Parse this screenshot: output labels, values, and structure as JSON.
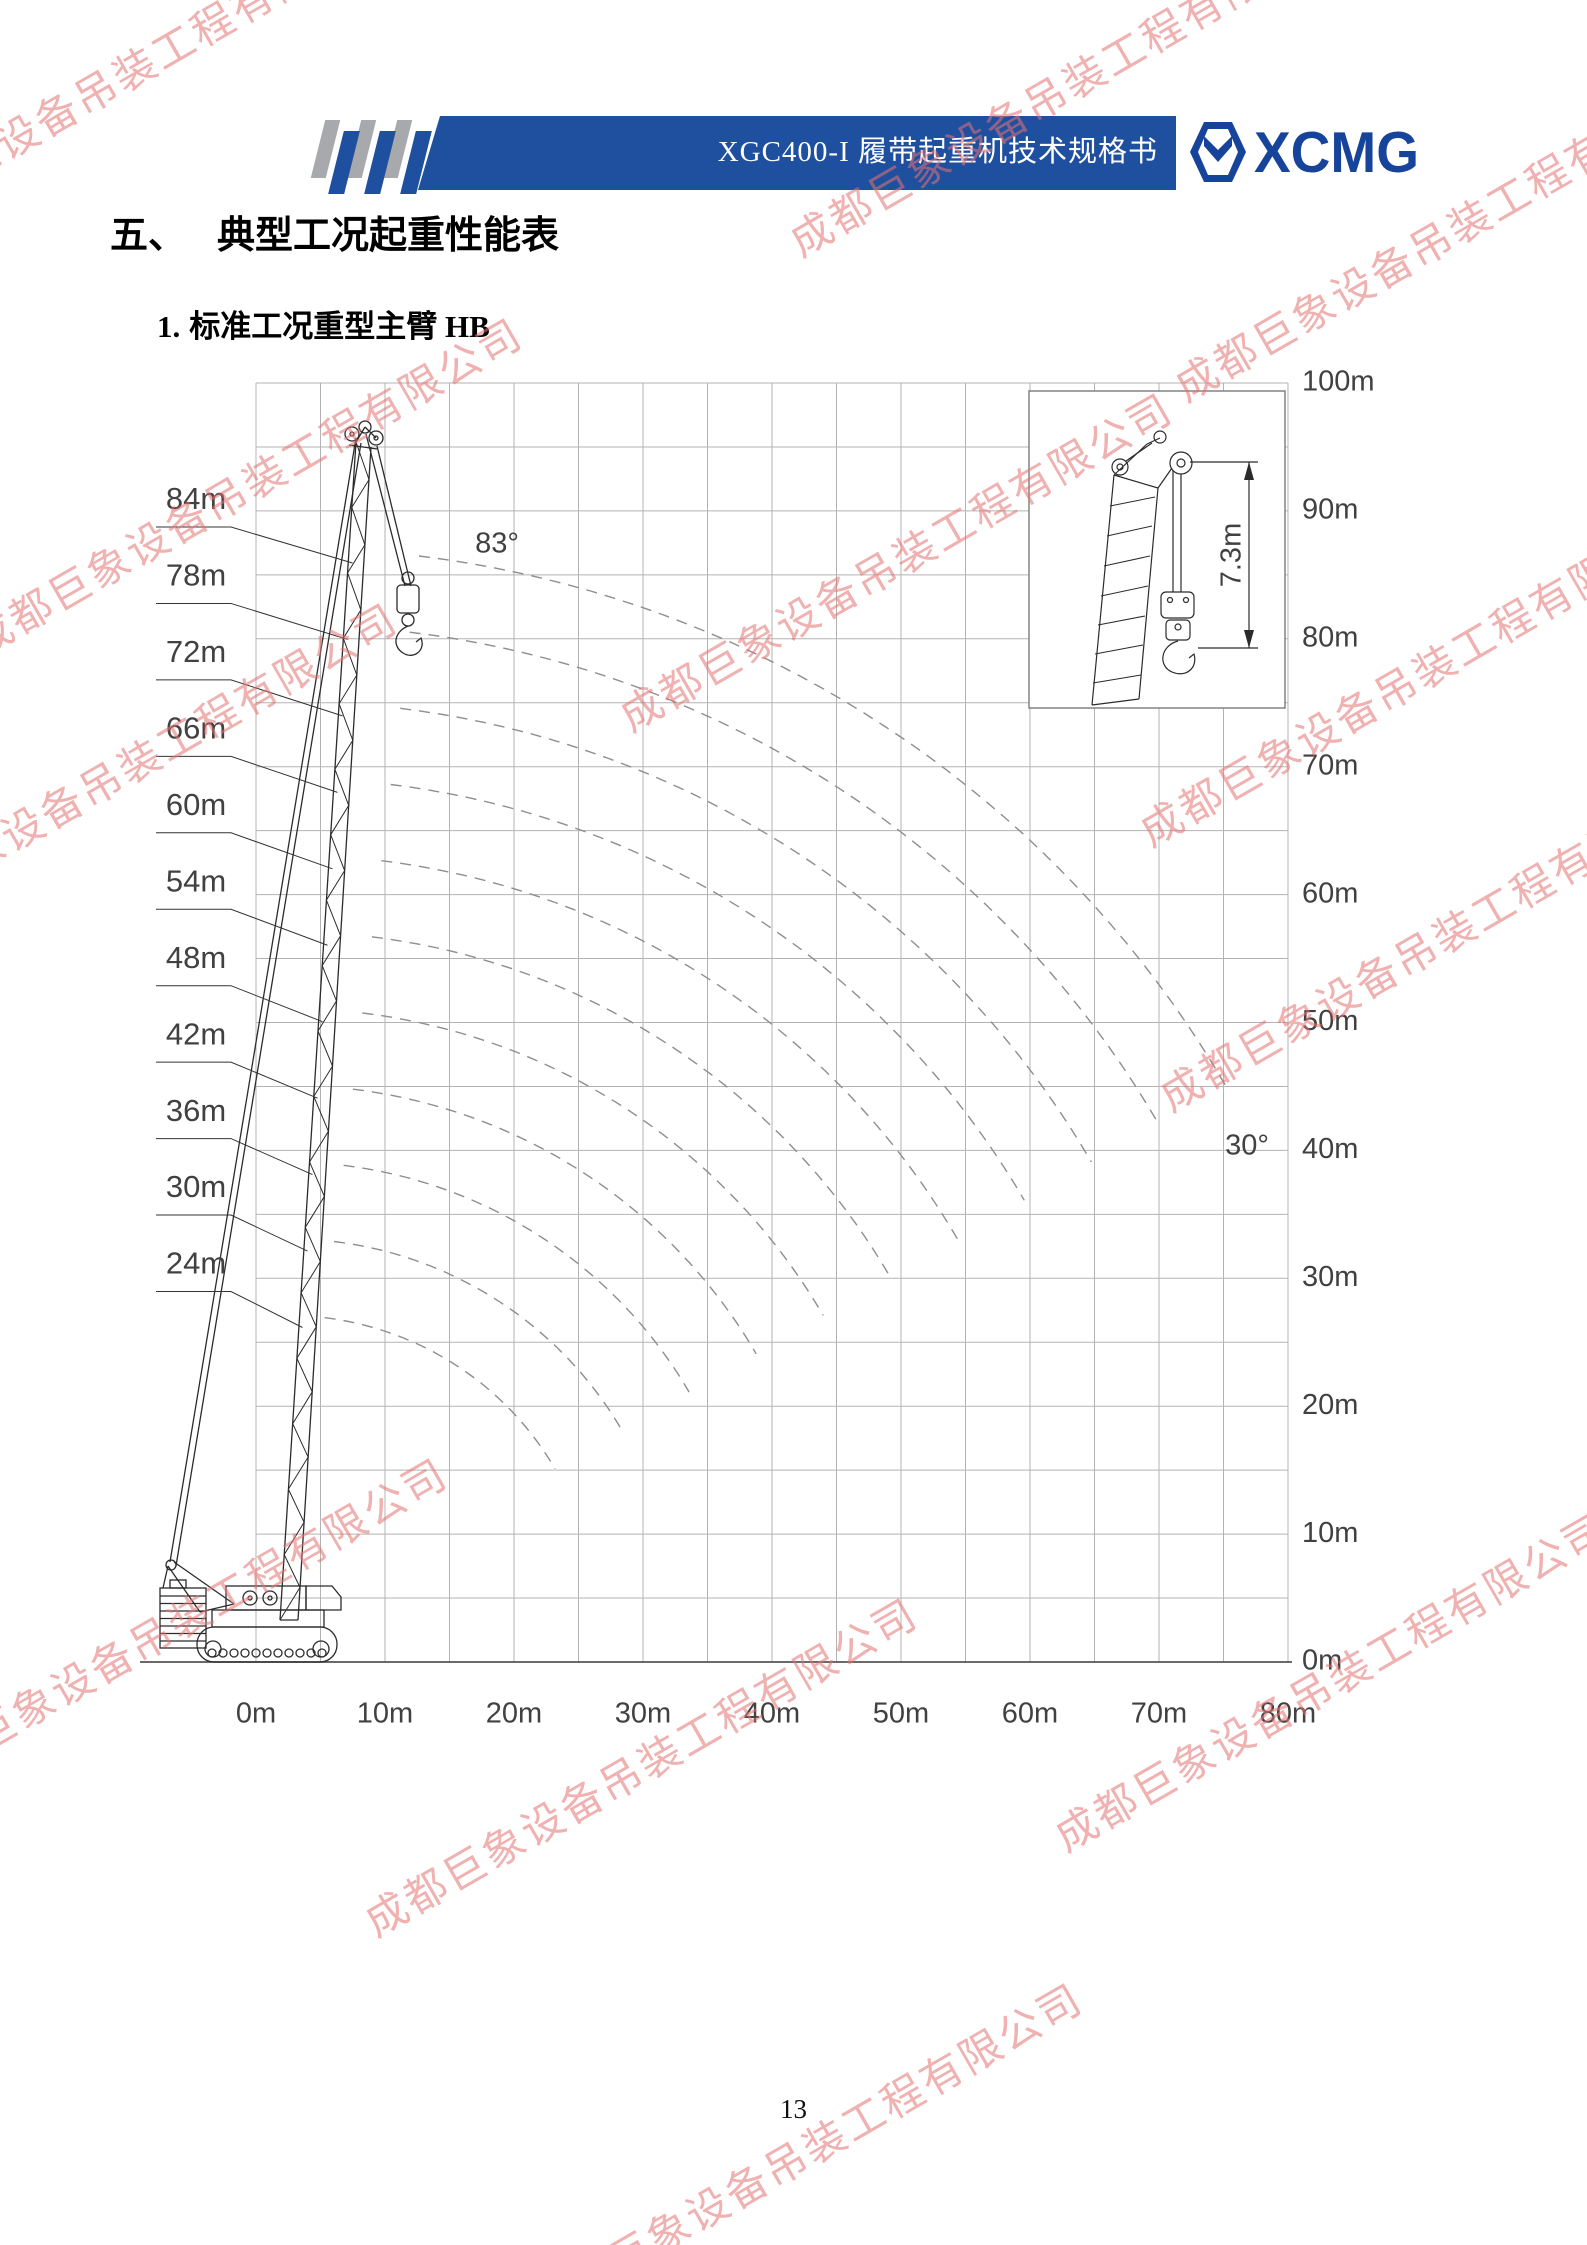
{
  "header": {
    "doc_title": "XGC400-I 履带起重机技术规格书",
    "logo_text": "XCMG",
    "bar_color": "#1f4f9f",
    "logo_color": "#17449b"
  },
  "section_title": {
    "number": "五、",
    "text": "典型工况起重性能表"
  },
  "subsection_title": {
    "number": "1.",
    "text": "标准工况重型主臂 HB"
  },
  "watermark": {
    "text": "成都巨象设备吊装工程有限公司",
    "color": "#e57373"
  },
  "footer": {
    "page_number": "13"
  },
  "chart_data": {
    "type": "line",
    "title": "标准工况重型主臂 HB 工作范围图",
    "x_axis": {
      "unit": "m",
      "min": 0,
      "max": 80,
      "tick_step": 10,
      "grid_step": 5,
      "tick_labels": [
        "0m",
        "10m",
        "20m",
        "30m",
        "40m",
        "50m",
        "60m",
        "70m",
        "80m"
      ]
    },
    "y_axis": {
      "unit": "m",
      "min": 0,
      "max": 100,
      "tick_step": 10,
      "grid_step": 5,
      "tick_labels": [
        "0m",
        "10m",
        "20m",
        "30m",
        "40m",
        "50m",
        "60m",
        "70m",
        "80m",
        "90m",
        "100m"
      ]
    },
    "boom_length_labels": [
      "84m",
      "78m",
      "72m",
      "66m",
      "60m",
      "54m",
      "48m",
      "42m",
      "36m",
      "30m",
      "24m"
    ],
    "boom_lengths_m": [
      84,
      78,
      72,
      66,
      60,
      54,
      48,
      42,
      36,
      30,
      24
    ],
    "boom_angle_deg": {
      "max": 83,
      "min": 30
    },
    "angle_labels": {
      "max": "83°",
      "min": "30°"
    },
    "boom_foot": {
      "radius_m": 2.4,
      "height_m": 3.1
    },
    "series_note": "Dashed curves trace the boom-tip position for each boom length as boom angle varies from 83° to 30°.",
    "inset": {
      "dimension_label": "7.3m"
    },
    "legend": "none",
    "grid": "on"
  }
}
